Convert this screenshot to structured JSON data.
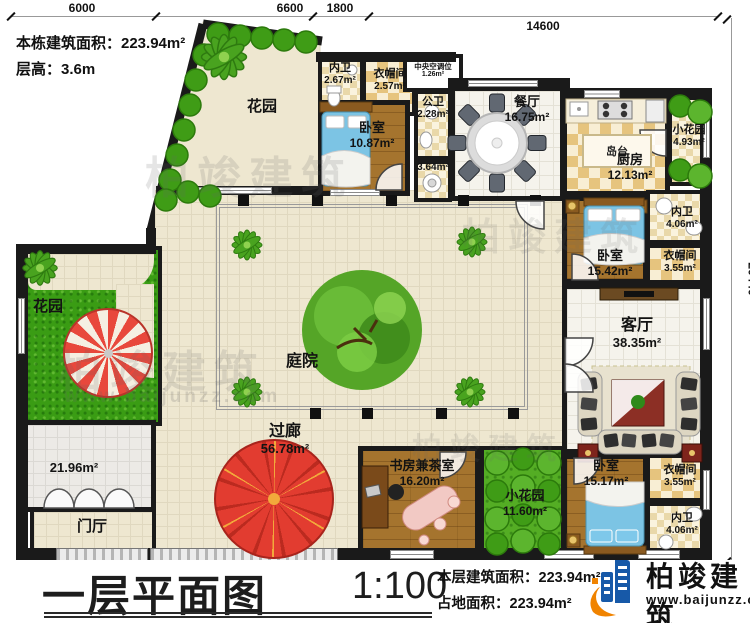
{
  "header": {
    "line1": "本栋建筑面积：223.94m²",
    "line2": "层高：3.6m"
  },
  "dimensions": {
    "top": [
      "6000",
      "6600",
      "1800",
      "14600"
    ],
    "right": "20440"
  },
  "rooms": {
    "garden_top": {
      "label": "花园"
    },
    "neiwei_top": {
      "label": "内卫",
      "area": "2.67m²"
    },
    "yimaojian_top": {
      "label": "衣帽间",
      "area": "2.57m²"
    },
    "hvac": {
      "label": "中央空调位",
      "area": "1.26m²"
    },
    "bedroom_top": {
      "label": "卧室",
      "area": "10.87m²"
    },
    "gongwei": {
      "label": "公卫",
      "area": "2.28m²"
    },
    "hall_util": {
      "area": "3.64m²"
    },
    "dining": {
      "label": "餐厅",
      "area": "16.75m²"
    },
    "island": {
      "label": "岛台"
    },
    "kitchen": {
      "label": "厨房",
      "area": "12.13m²"
    },
    "garden_topright": {
      "label": "小花园",
      "area": "4.93m²"
    },
    "neiwei_right": {
      "label": "内卫",
      "area": "4.06m²"
    },
    "bedroom_right": {
      "label": "卧室",
      "area": "15.42m²"
    },
    "yimaojian_right": {
      "label": "衣帽间",
      "area": "3.55m²"
    },
    "living": {
      "label": "客厅",
      "area": "38.35m²"
    },
    "bedroom_bottom": {
      "label": "卧室",
      "area": "15.17m²"
    },
    "yimaojian_bottom": {
      "label": "衣帽间",
      "area": "3.55m²"
    },
    "neiwei_bottom": {
      "label": "内卫",
      "area": "4.06m²"
    },
    "courtyard": {
      "label": "庭院"
    },
    "corridor": {
      "label": "过廊",
      "area": "56.78m²"
    },
    "study": {
      "label": "书房兼茶室",
      "area": "16.20m²"
    },
    "garden_bottom": {
      "label": "小花园",
      "area": "11.60m²"
    },
    "garden_left": {
      "label": "花园"
    },
    "hall_left": {
      "area": "21.96m²"
    },
    "foyer": {
      "label": "门厅"
    }
  },
  "footer": {
    "plan_title": "一层平面图",
    "scale": "1:100",
    "area_line1": "本层建筑面积：223.94m²",
    "area_line2": "占地面积：223.94m²"
  },
  "brand": {
    "name": "柏竣建筑",
    "url": "www.baijunzz.com"
  },
  "watermark": {
    "text": "柏竣建筑",
    "url": "www.baijunzz.com"
  },
  "colors": {
    "wall": "#1a1a1a",
    "wood_floor": "#a5742e",
    "grass": "#3a9c14",
    "tile": "#eee7d0",
    "bed": "#7cc4e4",
    "umbrella_red": "#e23c30",
    "brand_blue": "#1759a8",
    "brand_orange": "#f08300"
  }
}
